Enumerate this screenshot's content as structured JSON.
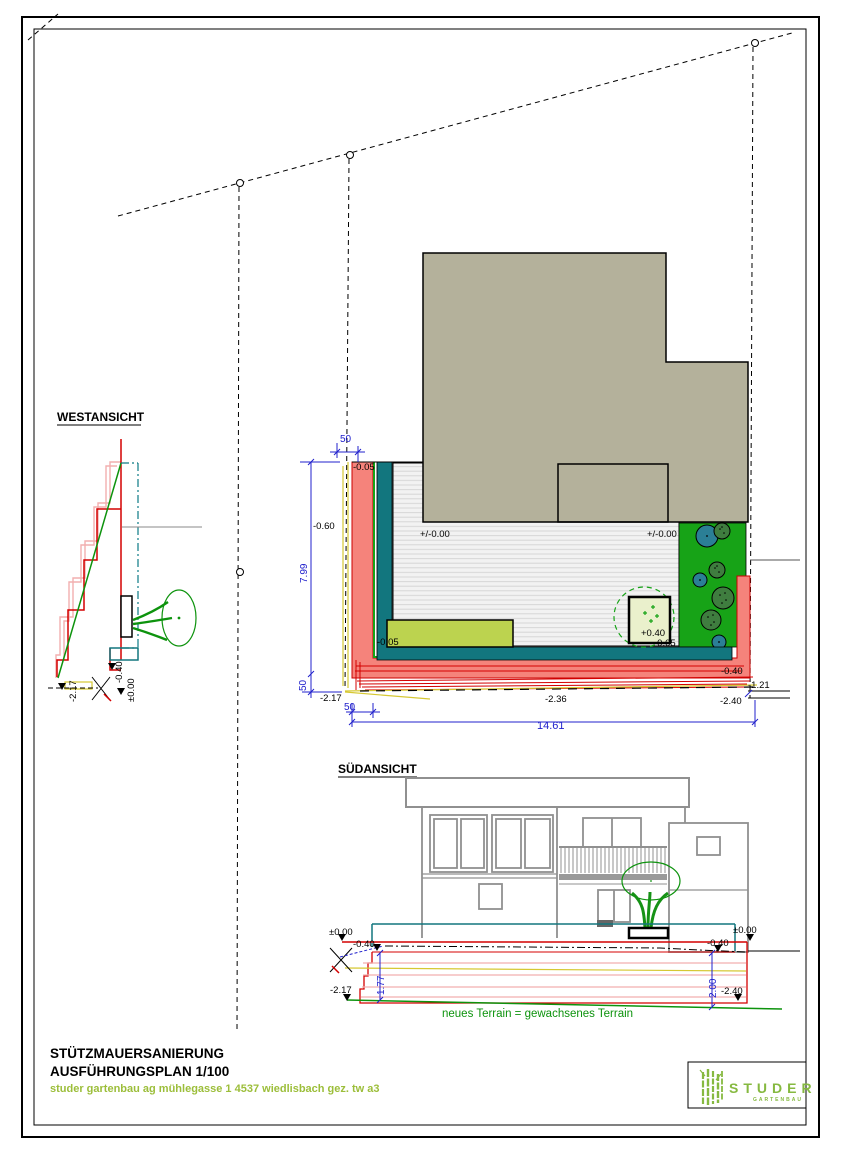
{
  "west": {
    "title": "WESTANSICHT",
    "lvl_217": "-2.17",
    "lvl_040": "-0.40",
    "lvl_000": "±0.00"
  },
  "plan": {
    "dim_top50": "50",
    "dim_799": "7.99",
    "dim_left50": "50",
    "dim_bot50": "50",
    "dim_1461": "14.61",
    "lbl_005_top": "-0.05",
    "lbl_060": "-0.60",
    "lbl_217": "-2.17",
    "lbl_000_left": "+/-0.00",
    "lbl_000_right": "+/-0.00",
    "lbl_005_mid": "-0.05",
    "lbl_040_plus": "+0.40",
    "lbl_005_right": "-0.05",
    "lbl_040_minus": "-0.40",
    "lbl_236": "-2.36",
    "lbl_121": "-1.21",
    "lbl_240": "-2.40"
  },
  "south": {
    "title": "SÜDANSICHT",
    "lbl_000_left": "±0.00",
    "lbl_000_right": "±0.00",
    "lbl_040_left": "-0.40",
    "lbl_040_right": "-0.40",
    "dim_177": "1.77",
    "dim_200": "2.00",
    "lbl_217": "-2.17",
    "lbl_240": "-2.40",
    "note": "neues Terrain = gewachsenes Terrain"
  },
  "title_block": {
    "project": "STÜTZMAUERSANIERUNG",
    "plan_name": "AUSFÜHRUNGSPLAN 1/100",
    "firm": "studer gartenbau ag mühlegasse 1 4537 wiedlisbach gez. tw a3"
  },
  "logo": {
    "name": "STUDER",
    "tagline": "GARTENBAU"
  },
  "colors": {
    "wall_new_fill": "#F5837B",
    "wall_new_line": "#CC0000",
    "wall_old": "#F2AFAF",
    "drainage_teal": "#12767E",
    "garden_green": "#17A317",
    "plant_green": "#0D930D",
    "planting_bed": "#BCD34F",
    "building_beige": "#B4B19B",
    "dim_blue": "#2020CC",
    "survey_yellow": "#D6C832",
    "brand_green": "#86B940",
    "firm_text_green": "#9CBE3A"
  }
}
